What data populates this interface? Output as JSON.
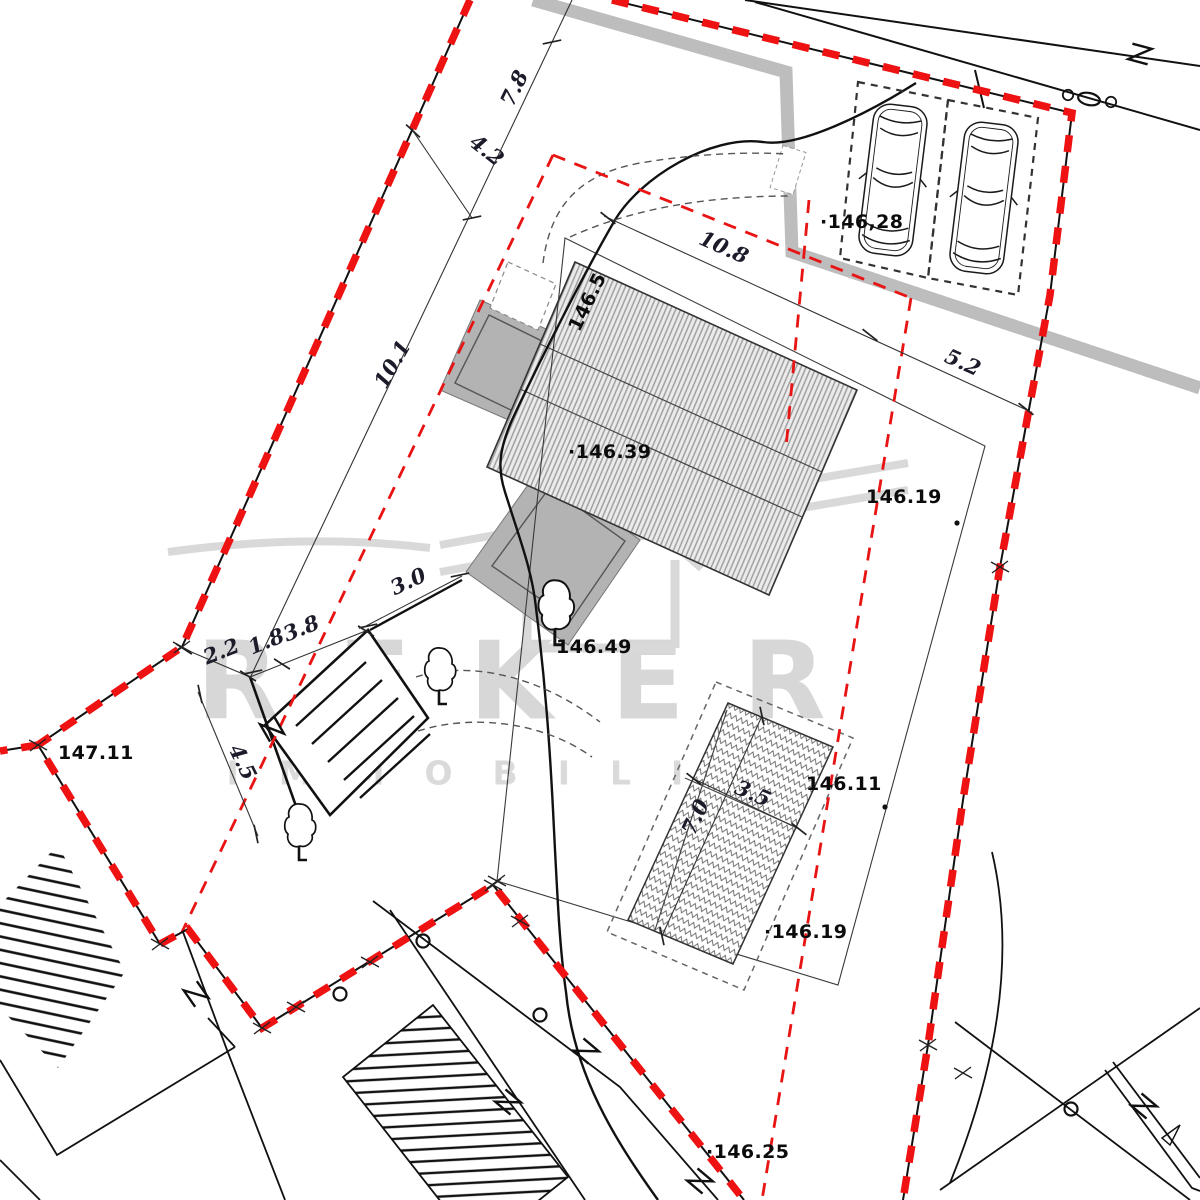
{
  "plan": {
    "watermark": {
      "brand": "REKER",
      "tagline": "IMMOBILIEN"
    },
    "colors": {
      "boundary_red": "#ee1212",
      "line_black": "#111111",
      "terrace_gray": "#b3b3b3",
      "road_band_gray": "#bdbdbd",
      "roof_hatch_gray": "#ebebeb",
      "watermark_gray": "#d7d7d7"
    },
    "elevation_labels": [
      {
        "text": "·146,28",
        "x": 820,
        "y": 222,
        "rot": 0
      },
      {
        "text": "146.5",
        "x": 574,
        "y": 330,
        "rot": -64
      },
      {
        "text": "·146.39",
        "x": 568,
        "y": 452,
        "rot": 0
      },
      {
        "text": "146.19",
        "x": 866,
        "y": 497,
        "rot": 0
      },
      {
        "text": "146.49",
        "x": 556,
        "y": 647,
        "rot": 0
      },
      {
        "text": "147.11",
        "x": 58,
        "y": 753,
        "rot": 0
      },
      {
        "text": "146.11",
        "x": 806,
        "y": 784,
        "rot": 0
      },
      {
        "text": "·146.19",
        "x": 764,
        "y": 932,
        "rot": 0
      },
      {
        "text": "·146.25",
        "x": 706,
        "y": 1152,
        "rot": 0
      }
    ],
    "dimension_labels": [
      {
        "text": "7.8",
        "x": 514,
        "y": 88,
        "rot": -64
      },
      {
        "text": "4.2",
        "x": 487,
        "y": 150,
        "rot": 38
      },
      {
        "text": "10.8",
        "x": 724,
        "y": 247,
        "rot": 24
      },
      {
        "text": "5.2",
        "x": 963,
        "y": 362,
        "rot": 24
      },
      {
        "text": "10.1",
        "x": 392,
        "y": 364,
        "rot": -60
      },
      {
        "text": "3.0",
        "x": 408,
        "y": 581,
        "rot": -25
      },
      {
        "text": "1.8",
        "x": 266,
        "y": 641,
        "rot": -22
      },
      {
        "text": "3.8",
        "x": 301,
        "y": 628,
        "rot": -22
      },
      {
        "text": "2.2",
        "x": 221,
        "y": 651,
        "rot": -22
      },
      {
        "text": "4.5",
        "x": 243,
        "y": 762,
        "rot": 64
      },
      {
        "text": "7.0",
        "x": 695,
        "y": 817,
        "rot": -65
      },
      {
        "text": "3.5",
        "x": 753,
        "y": 793,
        "rot": 23
      }
    ]
  }
}
